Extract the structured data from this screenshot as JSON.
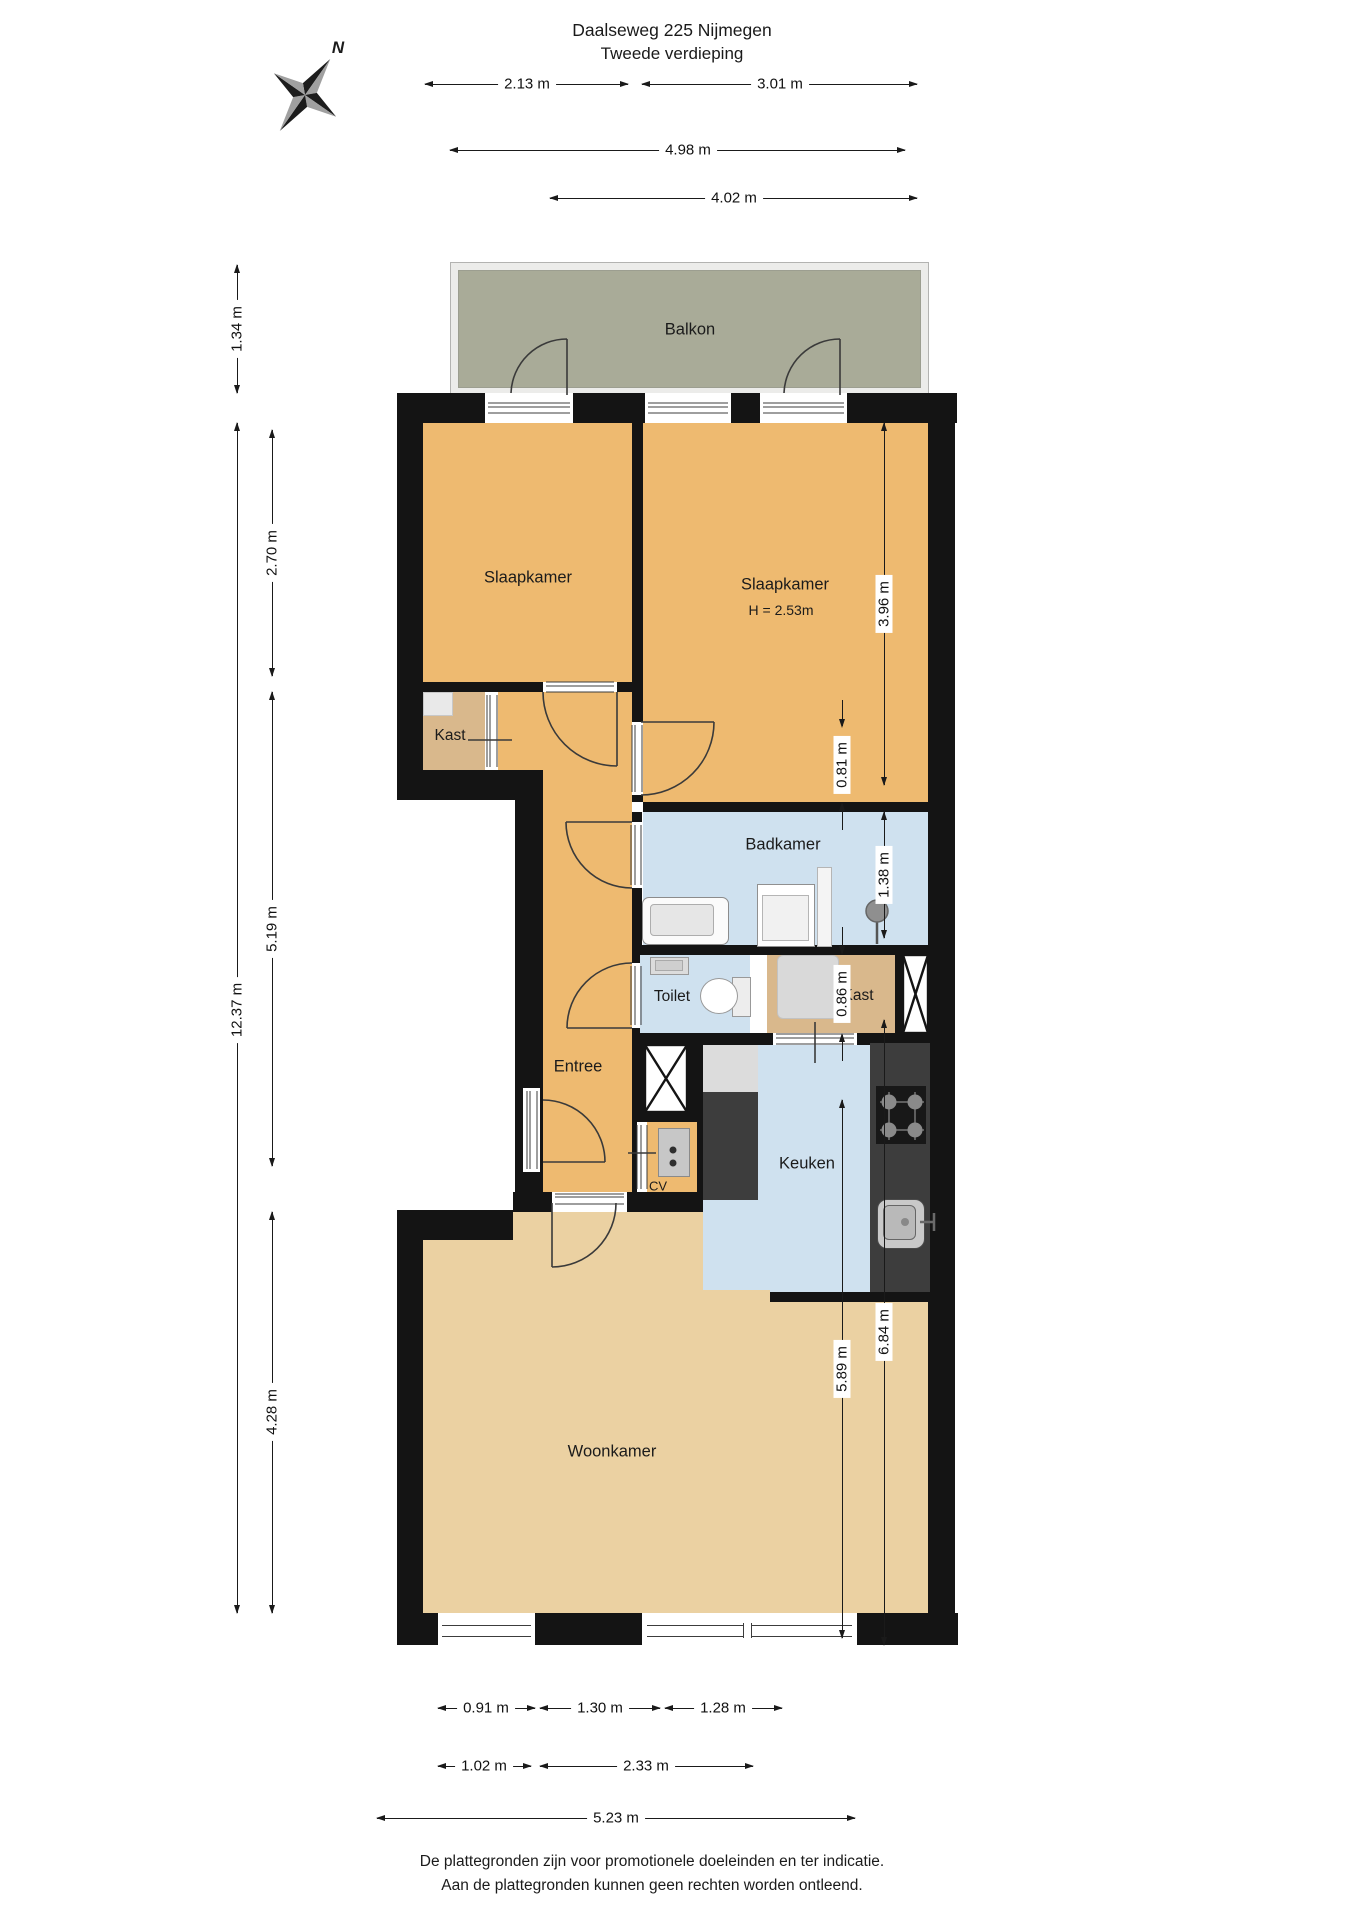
{
  "title": {
    "line1": "Daalseweg 225 Nijmegen",
    "line2": "Tweede verdieping"
  },
  "compass": {
    "north": "N"
  },
  "rooms": {
    "balkon": "Balkon",
    "slaapkamer_left": "Slaapkamer",
    "slaapkamer_right": "Slaapkamer",
    "slaapkamer_right_ceiling_height": "H = 2.53m",
    "kast_hal": "Kast",
    "badkamer": "Badkamer",
    "toilet": "Toilet",
    "kast_keuken": "Kast",
    "entree": "Entree",
    "cv": "CV",
    "keuken": "Keuken",
    "woonkamer": "Woonkamer"
  },
  "dims": {
    "d213": "2.13 m",
    "d301": "3.01 m",
    "d498": "4.98 m",
    "d402": "4.02 m",
    "d134": "1.34 m",
    "d1237": "12.37 m",
    "d270": "2.70 m",
    "d519": "5.19 m",
    "d428": "4.28 m",
    "d396": "3.96 m",
    "d081": "0.81 m",
    "d138": "1.38 m",
    "d086": "0.86 m",
    "d589": "5.89 m",
    "d684": "6.84 m",
    "d091": "0.91 m",
    "d130": "1.30 m",
    "d128": "1.28 m",
    "d102": "1.02 m",
    "d233": "2.33 m",
    "d523": "5.23 m"
  },
  "footer": {
    "line1": "De plattegronden zijn voor promotionele doeleinden en ter indicatie.",
    "line2": "Aan de plattegronden kunnen geen rechten worden ontleend."
  },
  "colors": {
    "wall": "#141414",
    "bedroom": "#eeba70",
    "closet": "#d9b88c",
    "living": "#ebd1a2",
    "wet": "#cfe1ef",
    "balcony": "#a9ab98",
    "counter": "#3d3d3d"
  }
}
